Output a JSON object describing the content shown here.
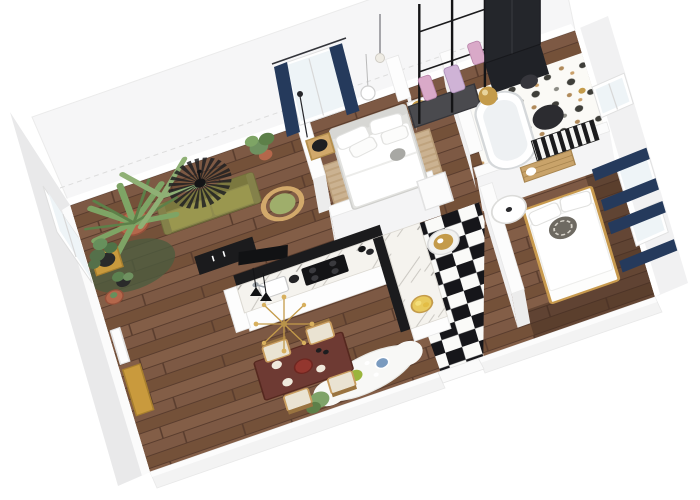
{
  "image": {
    "kind": "3d-floor-plan-render",
    "view": "isometric-top-down",
    "width": 700,
    "height": 500,
    "background": "#ffffff",
    "visible_text": []
  },
  "palette": {
    "bg": "#ffffff",
    "wall": "#f6f6f7",
    "wallShade": "#e9e9ea",
    "wallEdge": "#dddddd",
    "wood": "#7a5641",
    "woodLine": "#5a3d2e",
    "woodDark": "#4a3122",
    "navy": "#253a5c",
    "olive": "#8f8c4e",
    "oliveDark": "#6f6c3a",
    "rattan": "#d2a96b",
    "terracotta": "#b4674b",
    "leaf": "#87a671",
    "leafDark": "#55704a",
    "black": "#1b1b1d",
    "marble": "#f5f3ee",
    "vein": "#c6c3bd",
    "checkerDark": "#16161a",
    "checkerLight": "#fafaf8",
    "terrazzoBg": "#fbfaf6",
    "terrazzoDot": "#3f3f3a",
    "brass": "#c49b4a",
    "jute": "#cbb291",
    "juteLine": "#bfa37e",
    "mustard": "#c99a3d",
    "white": "#ffffff",
    "greyFurn": "#4a4a4e",
    "bedFrame": "#e3e3e0",
    "pink": "#d9a9c8",
    "red": "#93362e",
    "skyGlass": "#eef4f7",
    "woodFrame": "#c89a4e"
  },
  "apartment": {
    "rooms": [
      {
        "name": "living-room",
        "floor": "wood-planks",
        "furniture": [
          "olive-green-sofa",
          "rattan-fan-pendant-lamp",
          "palm-plant-terracotta-pot",
          "monstera-on-mustard-stool",
          "small-potted-plants",
          "dark-green-rug",
          "black-media-desk",
          "rattan-armchair-green-cushion",
          "mustard-bench",
          "white-wall-panel",
          "ficus-plant"
        ]
      },
      {
        "name": "kitchen",
        "floor": "wood-planks",
        "furniture": [
          "l-shaped-island-marble-top",
          "black-base-cabinets",
          "black-cooktop",
          "sink-with-faucet",
          "wine-bottles",
          "brass-sputnik-chandelier",
          "black-double-pendant",
          "gold-fruit-tray"
        ]
      },
      {
        "name": "dining-area",
        "floor": "wood-planks",
        "furniture": [
          "dark-red-wood-table",
          "four-wood-chairs-pale-cushions",
          "red-bowl",
          "bottles-and-plates",
          "white-sheepskin-rug",
          "green-plate",
          "blue-plate",
          "potted-plant"
        ]
      },
      {
        "name": "master-bedroom",
        "floor": "wood-planks",
        "furniture": [
          "white-double-bed",
          "grey-headboard",
          "white-pillows",
          "striped-jute-rug",
          "rattan-nightstand",
          "black-table-lamp",
          "thin-floor-lamp",
          "white-globe-pendant",
          "brass-ball-lamp-on-stand",
          "window-with-navy-curtains"
        ]
      },
      {
        "name": "walk-in-closet",
        "floor": "wood-planks",
        "furniture": [
          "black-pole-clothing-racks",
          "hanging-clothes-pink",
          "grey-dresser",
          "tall-dark-wardrobe",
          "brass-sphere-lantern",
          "pendant-bulb"
        ]
      },
      {
        "name": "bathroom",
        "floor": "terrazzo-dots",
        "furniture": [
          "freestanding-bathtub",
          "chrome-faucet",
          "round-dark-mirror",
          "black-white-striped-mat",
          "wooden-slat-bench",
          "towel-roll",
          "black-round-table",
          "brass-door-knob",
          "white-framed-window"
        ]
      },
      {
        "name": "second-bedroom",
        "floor": "wood-planks-dark",
        "furniture": [
          "wood-frame-double-bed",
          "white-duvet",
          "white-pillows",
          "patterned-round-cushion",
          "white-pedestal-table",
          "two-windows-with-navy-curtains"
        ]
      },
      {
        "name": "entry-hall",
        "floor": "black-white-checkerboard",
        "furniture": [
          "white-cylinder-stool",
          "gold-tray",
          "door-opening-south-wall"
        ]
      }
    ],
    "window_count": 6,
    "curtain_color": "navy",
    "wall_color": "white"
  }
}
